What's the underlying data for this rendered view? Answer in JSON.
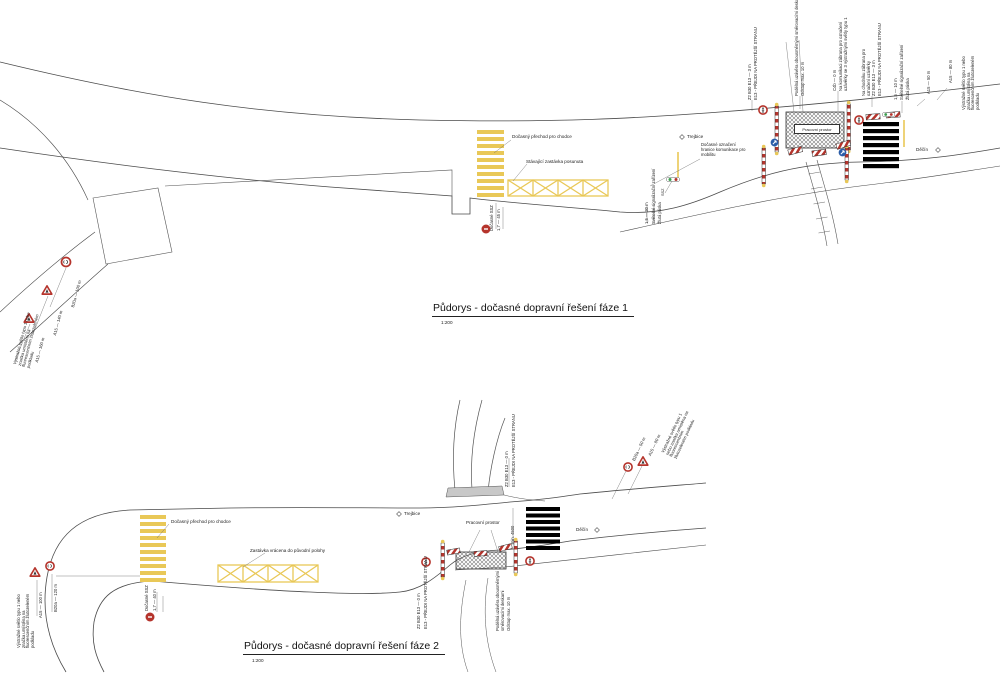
{
  "colors": {
    "road_line": "#4a4a4a",
    "marking_yellow": "#e9c857",
    "sign_red": "#b5342c",
    "sign_blue": "#2b5da8",
    "signal_green": "#3a9e4d",
    "zebra_black": "#000000"
  },
  "plan1": {
    "title": "Půdorys - dočasné dopravní řešení fáze 1",
    "scale": "1:200",
    "labels": {
      "temp_crossing": "Dočasný přechod pro chodce",
      "stop_moved": "Stávající zastávka posunuta",
      "mobility_note": "Dočasné označení hranice komunikace pro mobilitu",
      "work_area": "Pracovní prostor",
      "town_left": "Trejbice",
      "town_right": "Děčín",
      "ssz_small": "SSZ"
    },
    "left_signs": {
      "s1": "B20a — 100 m",
      "s2": "A15 — 140 m",
      "s3": "A15 — 160 m",
      "note": "Výstražné světlo typu 1 nebo značka umístěna na fluorescenčním žlutozeleném podkladu"
    },
    "ssz_mid": {
      "label": "Dočasné SSZ",
      "dim": "1,7 — 45 m"
    },
    "ssz_right": {
      "l1": "Světelné signalizační zařízení",
      "l2": "Žlutá páska",
      "dim": "1,5 — 30 m"
    },
    "top_notes": {
      "a1": "Z2  B30  E13 — 3 m",
      "a2": "E13 - PŘEJDI NA PROTĚJŠÍ STRANU",
      "b1": "Podélná uzávěra obousměrnými směrovacími deskami",
      "b2": "Odstup max. 10 m",
      "c1": "C4b — 0 m",
      "c2": "Na komunikaci zábrana pro označení uzávěrky se 3 výstražnými světly typu 1",
      "d1": "Na chodníku zábrana pro označení uzávěrky",
      "d2": "Z2  B30  E13 — 3 m",
      "d3": "E13 - PŘEJDI NA PROTĚJŠÍ STRANU",
      "e1": "1,5 — 10 m",
      "e2": "Světelné signalizační zařízení",
      "e3": "Žlutá páska",
      "f1": "A15 — 50 m",
      "f2": "A15 — 80 m",
      "g": "Výstražné světlo typu 1 nebo značka umístěna na fluorescenčním žlutozeleném podkladu"
    }
  },
  "plan2": {
    "title": "Půdorys - dočasné dopravní řešení fáze 2",
    "scale": "1:200",
    "labels": {
      "temp_crossing": "Dočasný přechod pro chodce",
      "stop_back": "Zastávka vrácena do původní polohy",
      "work_area": "Pracovní prostor",
      "town_left": "Trejbice",
      "town_right": "Děčín"
    },
    "left_signs": {
      "s1": "B20a — 120 m",
      "s2": "A15 — 100 m",
      "note": "Výstražné světlo typu 1 nebo značka umístěna na fluorescenčním žlutozeleném podkladu"
    },
    "right_signs": {
      "s1": "B20a — 50 m",
      "s2": "A15 — 80 m",
      "note": "Výstražné světlo typu 1 nebo značka umístěna na fluorescenčním žlutozeleném podkladu"
    },
    "ssz_mid": {
      "label": "Dočasné SSZ",
      "dim": "1,7 — 40 m"
    },
    "notes": {
      "branch1": "Z2  B30  E13 — 0 m",
      "branch2": "E13 - PŘEJDI NA PROTĚJŠÍ STRANU",
      "wz_l1": "Z2  B30  E13 — 0 m",
      "wz_l2": "E13 - PŘEJDI NA PROTĚJŠÍ STRANU",
      "wz_r1": "Podélná uzávěra obousměrnými směrovacími deskami",
      "wz_r2": "Odstup max. 10 m",
      "dim_zebra": "min. 4500"
    }
  }
}
